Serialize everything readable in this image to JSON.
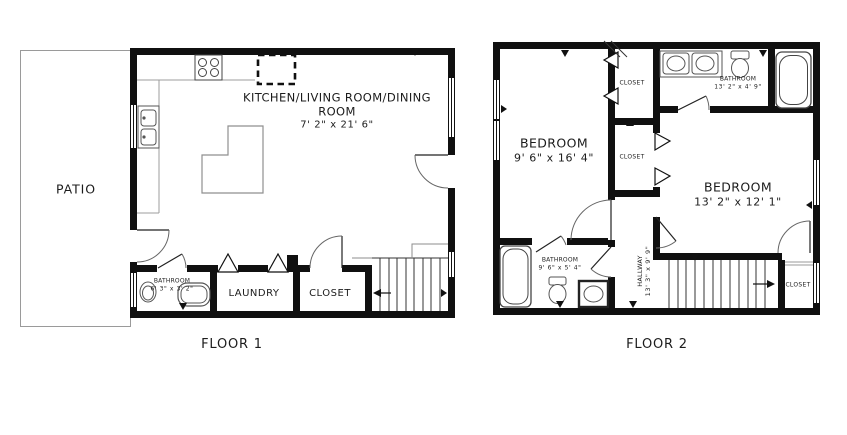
{
  "colors": {
    "wall": "#101010",
    "fixture": "#4a4a4a",
    "counter": "#9c9c9c"
  },
  "floor1": {
    "label": "FLOOR 1",
    "patio": {
      "name": "PATIO"
    },
    "main_room": {
      "name": "KITCHEN/LIVING ROOM/DINING ROOM",
      "dims": "7' 2\" x 21' 6\""
    },
    "bathroom": {
      "name": "BATHROOM",
      "dims": "6' 3\" x 3' 2\""
    },
    "laundry": {
      "name": "LAUNDRY"
    },
    "closet": {
      "name": "CLOSET"
    }
  },
  "floor2": {
    "label": "FLOOR 2",
    "bedroom1": {
      "name": "BEDROOM",
      "dims": "9' 6\" x 16' 4\""
    },
    "bedroom2": {
      "name": "BEDROOM",
      "dims": "13' 2\" x 12' 1\""
    },
    "bathroom_top": {
      "name": "BATHROOM",
      "dims": "13' 2\" x 4' 9\""
    },
    "bathroom_bottom": {
      "name": "BATHROOM",
      "dims": "9' 6\" x 5' 4\""
    },
    "hallway": {
      "name": "HALLWAY",
      "dims": "13' 3\" x 9' 9\""
    },
    "closet_top": {
      "name": "CLOSET"
    },
    "closet_mid": {
      "name": "CLOSET"
    },
    "closet_bottom": {
      "name": "CLOSET"
    }
  }
}
